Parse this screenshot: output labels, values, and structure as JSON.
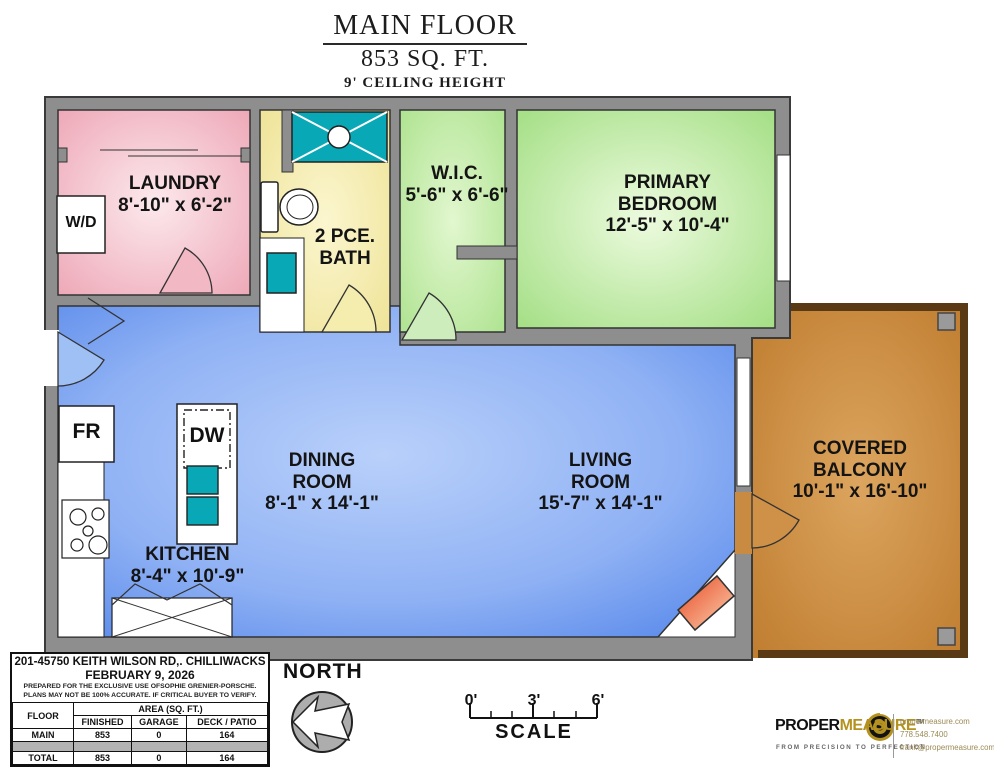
{
  "title": {
    "floor": "MAIN FLOOR",
    "area": "853 SQ. FT.",
    "ceiling": "9' CEILING HEIGHT"
  },
  "rooms": {
    "laundry": {
      "name": "LAUNDRY",
      "dims": "8'-10\" x 6'-2\""
    },
    "bath": {
      "name1": "2 PCE.",
      "name2": "BATH"
    },
    "wic": {
      "name": "W.I.C.",
      "dims": "5'-6\" x 6'-6\""
    },
    "bedroom": {
      "name1": "PRIMARY",
      "name2": "BEDROOM",
      "dims": "12'-5\" x 10'-4\""
    },
    "dining": {
      "name1": "DINING",
      "name2": "ROOM",
      "dims": "8'-1\" x 14'-1\""
    },
    "living": {
      "name1": "LIVING",
      "name2": "ROOM",
      "dims": "15'-7\" x 14'-1\""
    },
    "kitchen": {
      "name": "KITCHEN",
      "dims": "8'-4\" x 10'-9\""
    },
    "balcony": {
      "name1": "COVERED",
      "name2": "BALCONY",
      "dims": "10'-1\" x 16'-10\""
    }
  },
  "fixtures": {
    "washer_dryer": "W/D",
    "fridge": "FR",
    "dishwasher": "DW"
  },
  "info_box": {
    "address": "201-45750 KEITH WILSON RD,. CHILLIWACKS",
    "date": "FEBRUARY 9, 2026",
    "disclaimer1": "PREPARED FOR THE EXCLUSIVE USE OFSOPHIE GRENIER-PORSCHE.",
    "disclaimer2": "PLANS MAY NOT BE 100% ACCURATE. IF CRITICAL BUYER TO VERIFY.",
    "table": {
      "col_floor": "FLOOR",
      "col_area": "AREA (SQ. FT.)",
      "col_finished": "FINISHED",
      "col_garage": "GARAGE",
      "col_deck": "DECK / PATIO",
      "rows": [
        {
          "floor": "MAIN",
          "finished": "853",
          "garage": "0",
          "deck": "164"
        }
      ],
      "total": {
        "floor": "TOTAL",
        "finished": "853",
        "garage": "0",
        "deck": "164"
      }
    }
  },
  "compass": {
    "label": "NORTH"
  },
  "scale_bar": {
    "tick0": "0'",
    "tick3": "3'",
    "tick6": "6'",
    "label": "SCALE"
  },
  "branding": {
    "name_part1": "PROPER",
    "name_part2": "MEASURE",
    "tm": "TM",
    "tagline": "FROM PRECISION TO PERFECTION",
    "website": "propermeasure.com",
    "phone": "778.548.7400",
    "email": "frank@propermeasure.com"
  },
  "colors": {
    "wall": "#8e8e8e",
    "laundry_pink": "#eda4b4",
    "bath_yellow": "#f0e69c",
    "bedroom_green": "#9fdd7f",
    "living_blue": "#4a7fe8",
    "balcony_brown": "#bd7a2c",
    "fixture_teal": "#09a8b6",
    "fireplace_orange": "#e64722"
  }
}
